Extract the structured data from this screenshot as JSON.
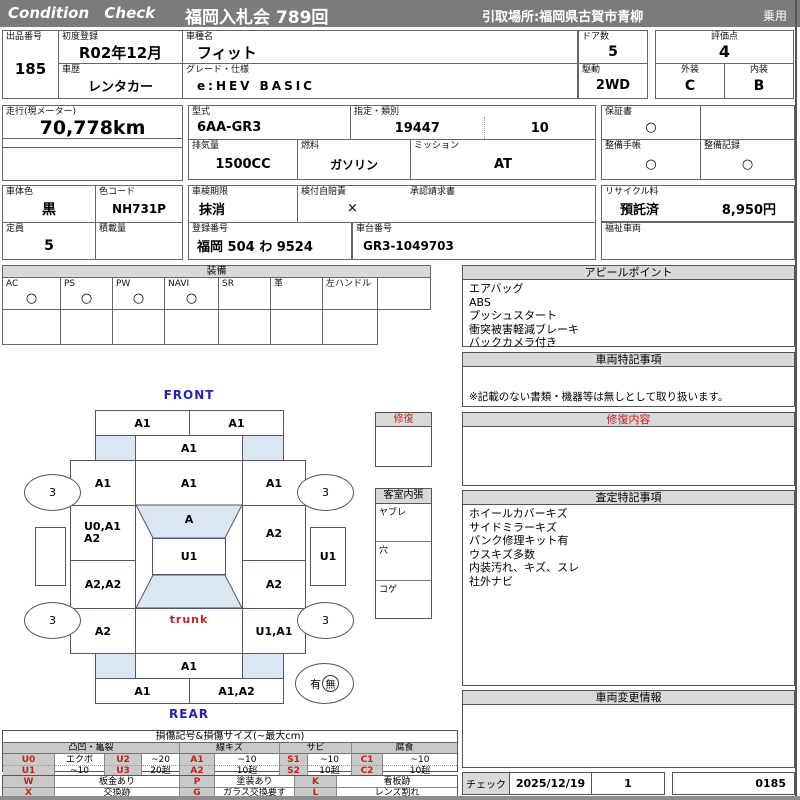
{
  "header": {
    "brand": "Condition Check",
    "auction": "福岡入札会 789回",
    "pickup": "引取場所:福岡県古賀市青柳",
    "vehicle_class": "乗用"
  },
  "info": {
    "exhibit": {
      "label": "出品番号",
      "value": "185"
    },
    "first_reg": {
      "label": "初度登録",
      "value": "R02年12月"
    },
    "model_name": {
      "label": "車種名",
      "value": "フィット"
    },
    "history": {
      "label": "車歴",
      "value": "レンタカー"
    },
    "grade": {
      "label": "グレード・仕様",
      "value": "e:HEV BASIC"
    },
    "doors": {
      "label": "ドア数",
      "value": "5"
    },
    "drive": {
      "label": "駆動",
      "value": "2WD"
    },
    "score": {
      "label": "評価点",
      "value": "4"
    },
    "exterior": {
      "label": "外装",
      "value": "C"
    },
    "interior": {
      "label": "内装",
      "value": "B"
    },
    "mileage": {
      "label": "走行(現メーター)",
      "value": "70,778km"
    },
    "model_code": {
      "label": "型式",
      "value": "6AA-GR3"
    },
    "class_no": {
      "label": "指定・類別",
      "value1": "19447",
      "value2": "10"
    },
    "displacement": {
      "label": "排気量",
      "value": "1500CC"
    },
    "fuel": {
      "label": "燃料",
      "value": "ガソリン"
    },
    "transmission": {
      "label": "ミッション",
      "value": "AT"
    },
    "warranty": {
      "label": "保証書",
      "value": "○"
    },
    "maintenance_book": {
      "label": "整備手帳",
      "value": "○"
    },
    "maintenance_record": {
      "label": "整備記録",
      "value": "○"
    },
    "body_color": {
      "label": "車体色",
      "value": "黒"
    },
    "color_code": {
      "label": "色コード",
      "value": "NH731P"
    },
    "inspection": {
      "label": "車検期限",
      "value": "抹消"
    },
    "insurance": {
      "label": "検付自賠責",
      "value": "×"
    },
    "approval": {
      "label": "承認請求書",
      "value": ""
    },
    "capacity": {
      "label": "定員",
      "value": "5"
    },
    "load": {
      "label": "積載量",
      "value": ""
    },
    "reg_no": {
      "label": "登録番号",
      "value": "福岡  504 わ 9524"
    },
    "chassis": {
      "label": "車台番号",
      "value": "GR3-1049703"
    },
    "recycle": {
      "label": "リサイクル料",
      "status": "預託済",
      "fee": "8,950円"
    },
    "welfare": {
      "label": "福祉車両",
      "value": ""
    }
  },
  "equipment": {
    "title": "装備",
    "items": [
      {
        "label": "AC",
        "value": "○"
      },
      {
        "label": "PS",
        "value": "○"
      },
      {
        "label": "PW",
        "value": "○"
      },
      {
        "label": "NAVI",
        "value": "○"
      },
      {
        "label": "SR",
        "value": ""
      },
      {
        "label": "革",
        "value": ""
      },
      {
        "label": "左ハンドル",
        "value": ""
      },
      {
        "label": "",
        "value": ""
      }
    ]
  },
  "panels": {
    "appeal": {
      "title": "アピールポイント",
      "lines": [
        "エアバッグ",
        "ABS",
        "プッシュスタート",
        "衝突被害軽減ブレーキ",
        "バックカメラ付き"
      ]
    },
    "vehicle_notes": {
      "title": "車両特記事項",
      "note": "※記載のない書類・機器等は無しとして取り扱います。"
    },
    "repair_content": {
      "title": "修復内容"
    },
    "assessment": {
      "title": "査定特記事項",
      "lines": [
        "ホイールカバーキズ",
        "サイドミラーキズ",
        "パンク修理キット有",
        "ウスキズ多数",
        "内装汚れ、キズ、スレ",
        "社外ナビ"
      ]
    },
    "change_info": {
      "title": "車両変更情報"
    },
    "check": {
      "label": "チェック",
      "date": "2025/12/19",
      "count": "1",
      "sheet_no": "0185"
    }
  },
  "diagram": {
    "front_label": "FRONT",
    "rear_label": "REAR",
    "front_bumper_l": "A1",
    "front_bumper_r": "A1",
    "hood": "A1",
    "fender_fl": "A1",
    "windshield": "A1",
    "fender_fr": "A1",
    "door_fl_line1": "U0,A1",
    "door_fl_line2": "A2",
    "roof": "A",
    "door_fr": "A2",
    "center": "U1",
    "rocker_l": "",
    "rocker_r": "U1",
    "door_rl": "A2,A2",
    "door_rr": "A2",
    "fender_rl": "A2",
    "trunk": "trunk",
    "fender_rr": "U1,A1",
    "hatch": "A1",
    "rear_bumper_l": "A1",
    "rear_bumper_r": "A1,A2",
    "tire_fl": "3",
    "tire_fr": "3",
    "tire_rl": "3",
    "tire_rr": "3",
    "spare_yes": "有",
    "spare_no": "無",
    "repair_box_title": "修復",
    "cabin_box_title": "客室内張",
    "cabin_rows": [
      "ヤブレ",
      "穴",
      "コゲ"
    ]
  },
  "legend": {
    "title": "損傷記号&損傷サイズ(~最大cm)",
    "groups": [
      "凸凹・亀裂",
      "線キズ",
      "サビ",
      "腐食"
    ],
    "rows": [
      [
        "U0",
        "エクボ",
        "U2",
        "~20",
        "A1",
        "~10",
        "S1",
        "~10",
        "C1",
        "~10"
      ],
      [
        "U1",
        "~10",
        "U3",
        "20超",
        "A2",
        "10超",
        "S2",
        "10超",
        "C2",
        "10超"
      ]
    ],
    "rows2": [
      [
        "W",
        "板金あり",
        "P",
        "塗装あり",
        "K",
        "看板跡"
      ],
      [
        "X",
        "交換跡",
        "G",
        "ガラス交換要す",
        "L",
        "レンズ割れ"
      ]
    ]
  },
  "colors": {
    "header_bar": "#7b7b7b",
    "panel_title_bg": "#d9d9d9",
    "legend_code_bg": "#c9c9c9",
    "shade_blue": "#dce6f2",
    "accent_red": "#c22222",
    "accent_blue": "#2222bb"
  }
}
